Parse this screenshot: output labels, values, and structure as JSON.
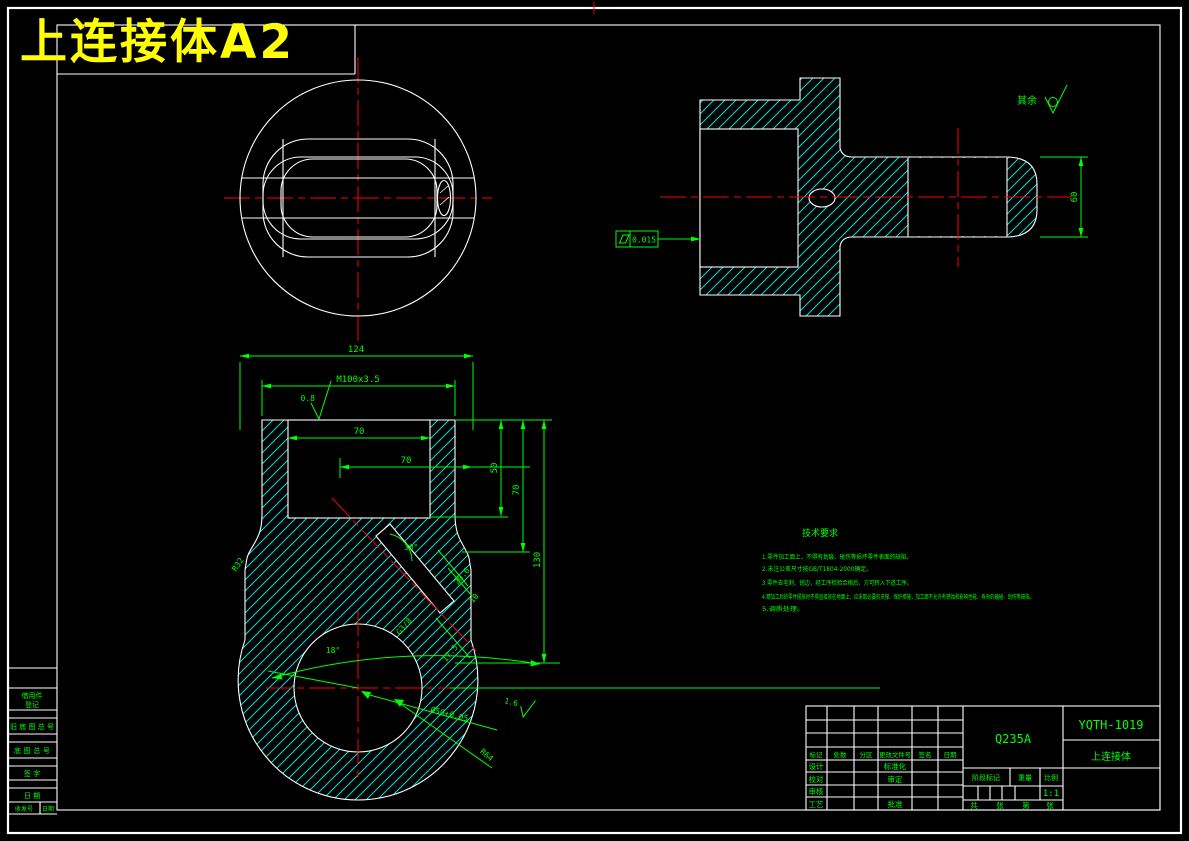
{
  "title": "上连接体A2",
  "colors": {
    "background": "#000000",
    "line": "#ffffff",
    "hatch": "#00dede",
    "centerline": "#ff0000",
    "annotation": "#00ff00",
    "title_text": "#ffff00"
  },
  "annotations": {
    "dim_124": "124",
    "thread_top": "M100x3.5",
    "rough_top": "0.8",
    "dim_70_bore": "70",
    "dim_70_offset": "70",
    "dim_50": "50",
    "dim_70_depth": "70",
    "dim_130": "130",
    "angle_30": "30°",
    "fillet_r32": "R32",
    "angle_18": "18°",
    "thread_g38": "G3/8",
    "dim_20_6": "20.6",
    "dim_10": "10",
    "dim_17_5": "17.5",
    "dim_bore": "Ø50+0.05",
    "rough_bore": "1.6",
    "radius_r64": "R64",
    "dim_60": "60",
    "flatness_value": "0.015",
    "rest_label": "其余"
  },
  "tech_req": {
    "heading": "技术要求",
    "lines": [
      "1.零件加工面上，不得有划痕、碰伤等损坏零件表面的缺陷。",
      "2.未注公差尺寸按GB/T1804-2000确定。",
      "3.零件去毛刺、锐边，经工序检验合格后，方可转入下道工序。",
      "4.精加工后的零件摆放时不得直接放在地面上，应采取必要的支撑、保护措施，加工面不允许有锈蚀和影响性能、寿命的磕碰、划伤等缺陷。",
      "5.调质处理。"
    ]
  },
  "title_block": {
    "material": "Q235A",
    "drawing_no": "YQTH-1019",
    "part_name": "上连接体",
    "scale_value": "1:1",
    "headers": [
      "标记",
      "处数",
      "分区",
      "更改文件号",
      "签名",
      "日期"
    ],
    "roles": [
      "设计",
      "校对",
      "审核",
      "工艺"
    ],
    "approvals": [
      "标准化",
      "审定",
      "批准"
    ],
    "stage_label": "阶段标记",
    "weight_label": "重量",
    "scale_label": "比例",
    "sheet_labels": [
      "共",
      "张",
      "第",
      "张"
    ]
  },
  "side_table": {
    "borrow_line1": "借用件",
    "borrow_line2": "登记",
    "old_base_no": "旧底图总号",
    "base_no": "底图总号",
    "sign": "签 字",
    "date": "日 期",
    "recv_no": "收发号",
    "recv_date": "日期"
  }
}
